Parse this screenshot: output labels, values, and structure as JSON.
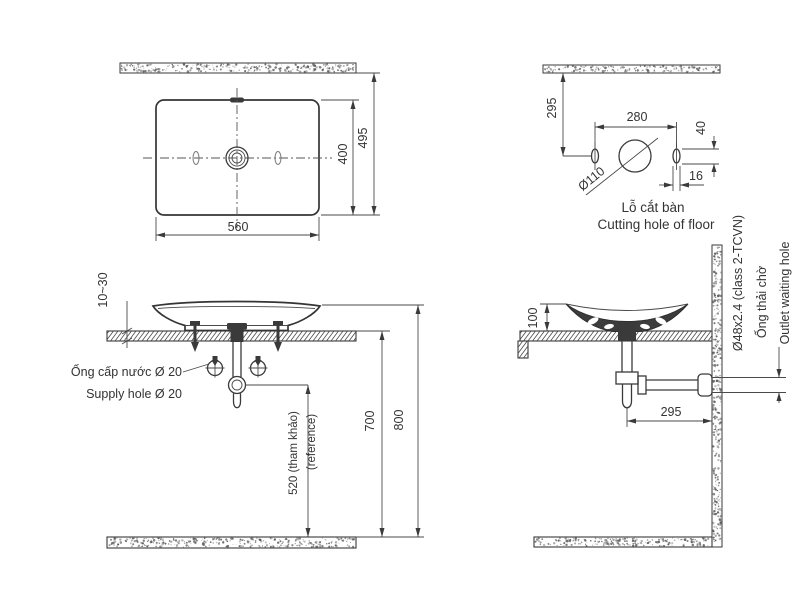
{
  "drawing": {
    "views": {
      "plan": {
        "dims": {
          "basin_width": "560",
          "basin_depth": "400",
          "overall_depth": "495"
        }
      },
      "cutting_hole": {
        "dims": {
          "center_from_wall": "295",
          "hole_spacing": "280",
          "slot_height": "40",
          "slot_width": "16",
          "hole_diameter": "Ø110"
        },
        "label_vi": "Lỗ cắt bàn",
        "label_en": "Cutting hole of floor"
      },
      "front_elevation": {
        "dims": {
          "counter_thickness": "10~30",
          "trap_height_ref": "520 (tham khảo)",
          "trap_height_ref_en": "(reference)",
          "counter_height": "700",
          "rim_height": "800"
        },
        "supply_label_vi": "Ống cấp nước Ø 20",
        "supply_label_en": "Supply hole Ø 20"
      },
      "side_elevation": {
        "dims": {
          "bowl_height": "100",
          "drain_to_wall": "295"
        },
        "outlet_spec": "Ø48x2.4 (class 2-TCVN)",
        "outlet_label_vi": "Ống thải chờ",
        "outlet_label_en": "Outlet waiting hole"
      }
    },
    "colors": {
      "line": "#3a3a3a",
      "text": "#333333",
      "background": "#ffffff"
    }
  }
}
